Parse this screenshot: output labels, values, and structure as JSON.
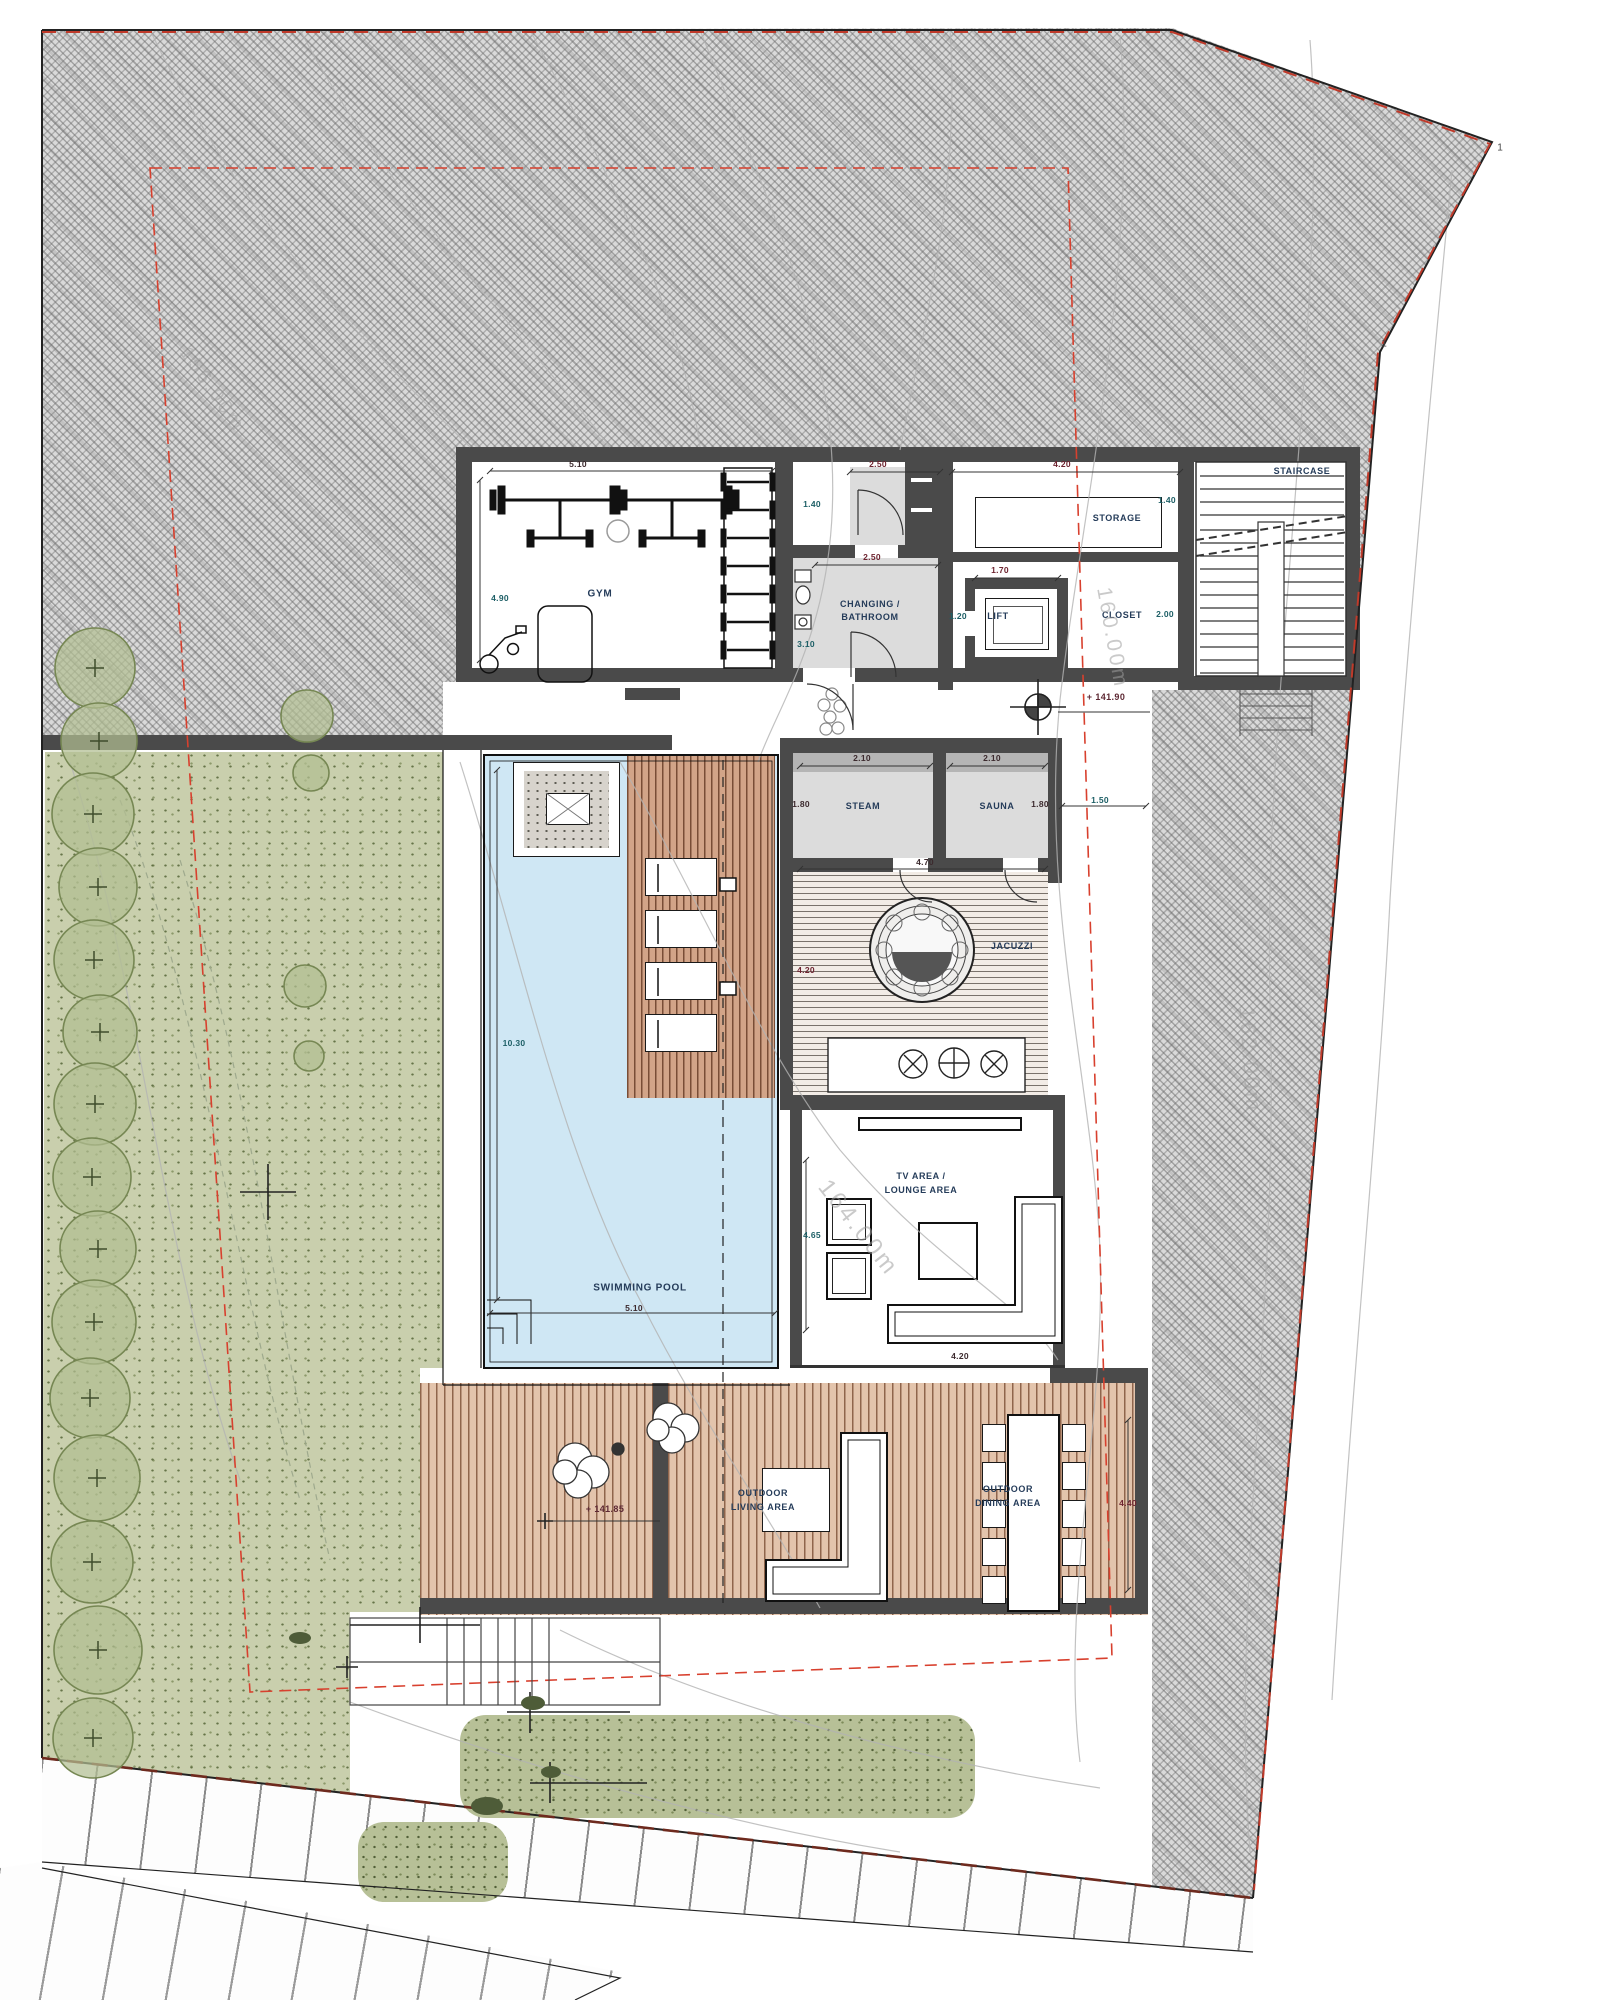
{
  "labels": {
    "gym": "GYM",
    "changing1": "CHANGING /",
    "changing2": "BATHROOM",
    "storage": "STORAGE",
    "lift": "LIFT",
    "closet": "CLOSET",
    "staircase": "STAIRCASE",
    "steam": "STEAM",
    "sauna": "SAUNA",
    "jacuzzi": "JACUZZI",
    "tv1": "TV AREA /",
    "tv2": "LOUNGE AREA",
    "pool": "SWIMMING POOL",
    "outdoor": "OUTDOOR",
    "living": "LIVING AREA",
    "dining": "DINING AREA"
  },
  "dimensions": {
    "d510": "5.10",
    "d490": "4.90",
    "d250": "2.50",
    "d140": "1.40",
    "d310": "3.10",
    "d420": "4.20",
    "d170": "1.70",
    "d120": "1.20",
    "d200": "2.00",
    "d210": "2.10",
    "d180": "1.80",
    "d150": "1.50",
    "d470": "4.70",
    "d1030": "10.30",
    "d465": "4.65",
    "d440": "4.40"
  },
  "levels": {
    "l14190": "+ 141.90",
    "l14185": "+ 141.85"
  },
  "contour_labels": {
    "c164": "164.00m",
    "c162": "162.00m",
    "c160": "160.00m",
    "c156": "156.00m"
  },
  "boundary_marks": {
    "m1": "1"
  },
  "colors": {
    "wall": "#4a4a4a",
    "water": "#cfe7f4",
    "deck_wood": "#e3c4ac",
    "garden": "#c9cfad",
    "site_hatch": "#d9d9d9",
    "setback_red": "#d8402e",
    "road_dashed": "#6e2a1e",
    "label_navy": "#253c5a"
  }
}
